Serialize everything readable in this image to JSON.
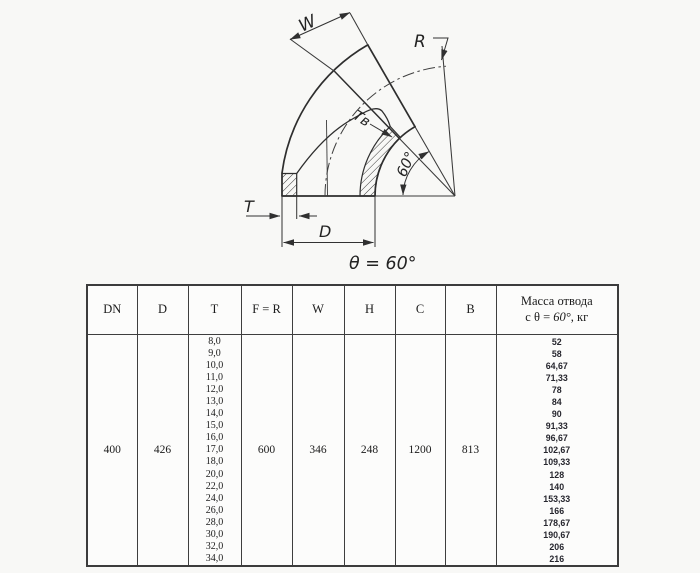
{
  "diagram": {
    "labels": {
      "w": "W",
      "r": "R",
      "t_wall_bend": "Тв",
      "angle_arc": "60°",
      "t_wall": "T",
      "d_outer": "D",
      "theta_caption": "θ = 60°"
    }
  },
  "table": {
    "headers": {
      "dn": "DN",
      "d": "D",
      "t": "T",
      "f_r": "F = R",
      "w": "W",
      "h": "H",
      "c": "C",
      "b": "B",
      "mass_line1": "Масса отвода",
      "mass_prefix": "с θ = ",
      "mass_angle": "60°",
      "mass_suffix": ", кг"
    },
    "row": {
      "dn": "400",
      "d": "426",
      "t_values": [
        "8,0",
        "9,0",
        "10,0",
        "11,0",
        "12,0",
        "13,0",
        "14,0",
        "15,0",
        "16,0",
        "17,0",
        "18,0",
        "20,0",
        "22,0",
        "24,0",
        "26,0",
        "28,0",
        "30,0",
        "32,0",
        "34,0"
      ],
      "f_r": "600",
      "w": "346",
      "h": "248",
      "c": "1200",
      "b": "813",
      "mass_values": [
        "52",
        "58",
        "64,67",
        "71,33",
        "78",
        "84",
        "90",
        "91,33",
        "96,67",
        "102,67",
        "109,33",
        "128",
        "140",
        "153,33",
        "166",
        "178,67",
        "190,67",
        "206",
        "216"
      ]
    }
  }
}
